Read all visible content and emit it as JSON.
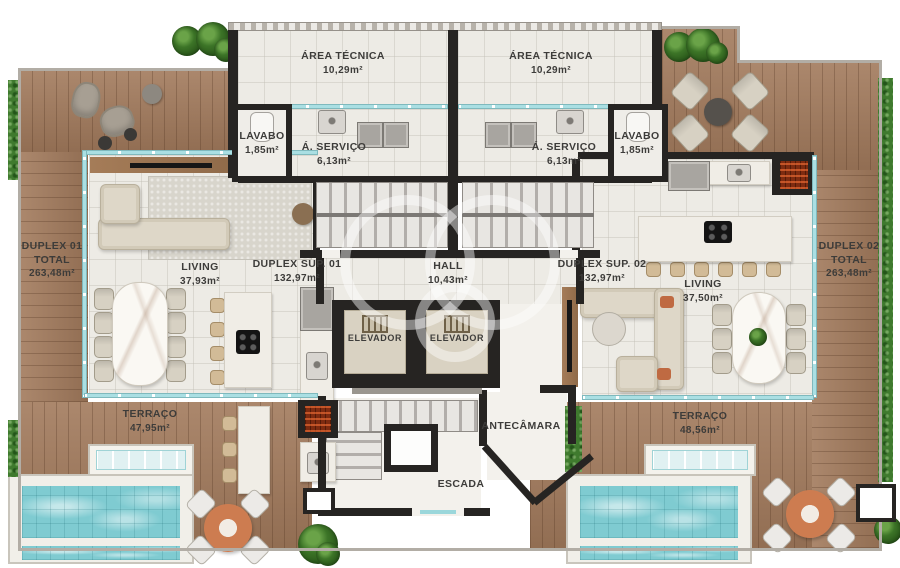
{
  "plan_title": "Duplex penthouse floor plan",
  "labels": {
    "area_tecnica_1": {
      "name": "ÁREA TÉCNICA",
      "area": "10,29m²"
    },
    "area_tecnica_2": {
      "name": "ÁREA TÉCNICA",
      "area": "10,29m²"
    },
    "lavabo_1": {
      "name": "LAVABO",
      "area": "1,85m²"
    },
    "lavabo_2": {
      "name": "LAVABO",
      "area": "1,85m²"
    },
    "servico_1": {
      "name": "Á. SERVIÇO",
      "area": "6,13m²"
    },
    "servico_2": {
      "name": "Á. SERVIÇO",
      "area": "6,13m²"
    },
    "duplex_total_1": {
      "name": "DUPLEX 01",
      "line2": "TOTAL",
      "area": "263,48m²"
    },
    "duplex_total_2": {
      "name": "DUPLEX 02",
      "line2": "TOTAL",
      "area": "263,48m²"
    },
    "living_1": {
      "name": "LIVING",
      "area": "37,93m²"
    },
    "living_2": {
      "name": "LIVING",
      "area": "37,50m²"
    },
    "duplex_sup_1": {
      "name": "DUPLEX SUP. 01",
      "area": "132,97m²"
    },
    "duplex_sup_2": {
      "name": "DUPLEX SUP. 02",
      "area": "132,97m²"
    },
    "hall": {
      "name": "HALL",
      "area": "10,43m²"
    },
    "elevador_1": {
      "name": "ELEVADOR"
    },
    "elevador_2": {
      "name": "ELEVADOR"
    },
    "terraco_1": {
      "name": "TERRAÇO",
      "area": "47,95m²"
    },
    "terraco_2": {
      "name": "TERRAÇO",
      "area": "48,56m²"
    },
    "antecamara": {
      "name": "ANTECÂMARA"
    },
    "escada": {
      "name": "ESCADA"
    }
  },
  "colors": {
    "wood_deck": "#a27a5c",
    "hedge_green": "#3f7a2e",
    "pool_water": "#7fcbd1",
    "wall_dark": "#262422",
    "interior_floor": "#edebe5",
    "glass_teal": "#aadfe3",
    "grill_brick": "#7e2b10",
    "terracotta_table": "#cd7c50"
  }
}
